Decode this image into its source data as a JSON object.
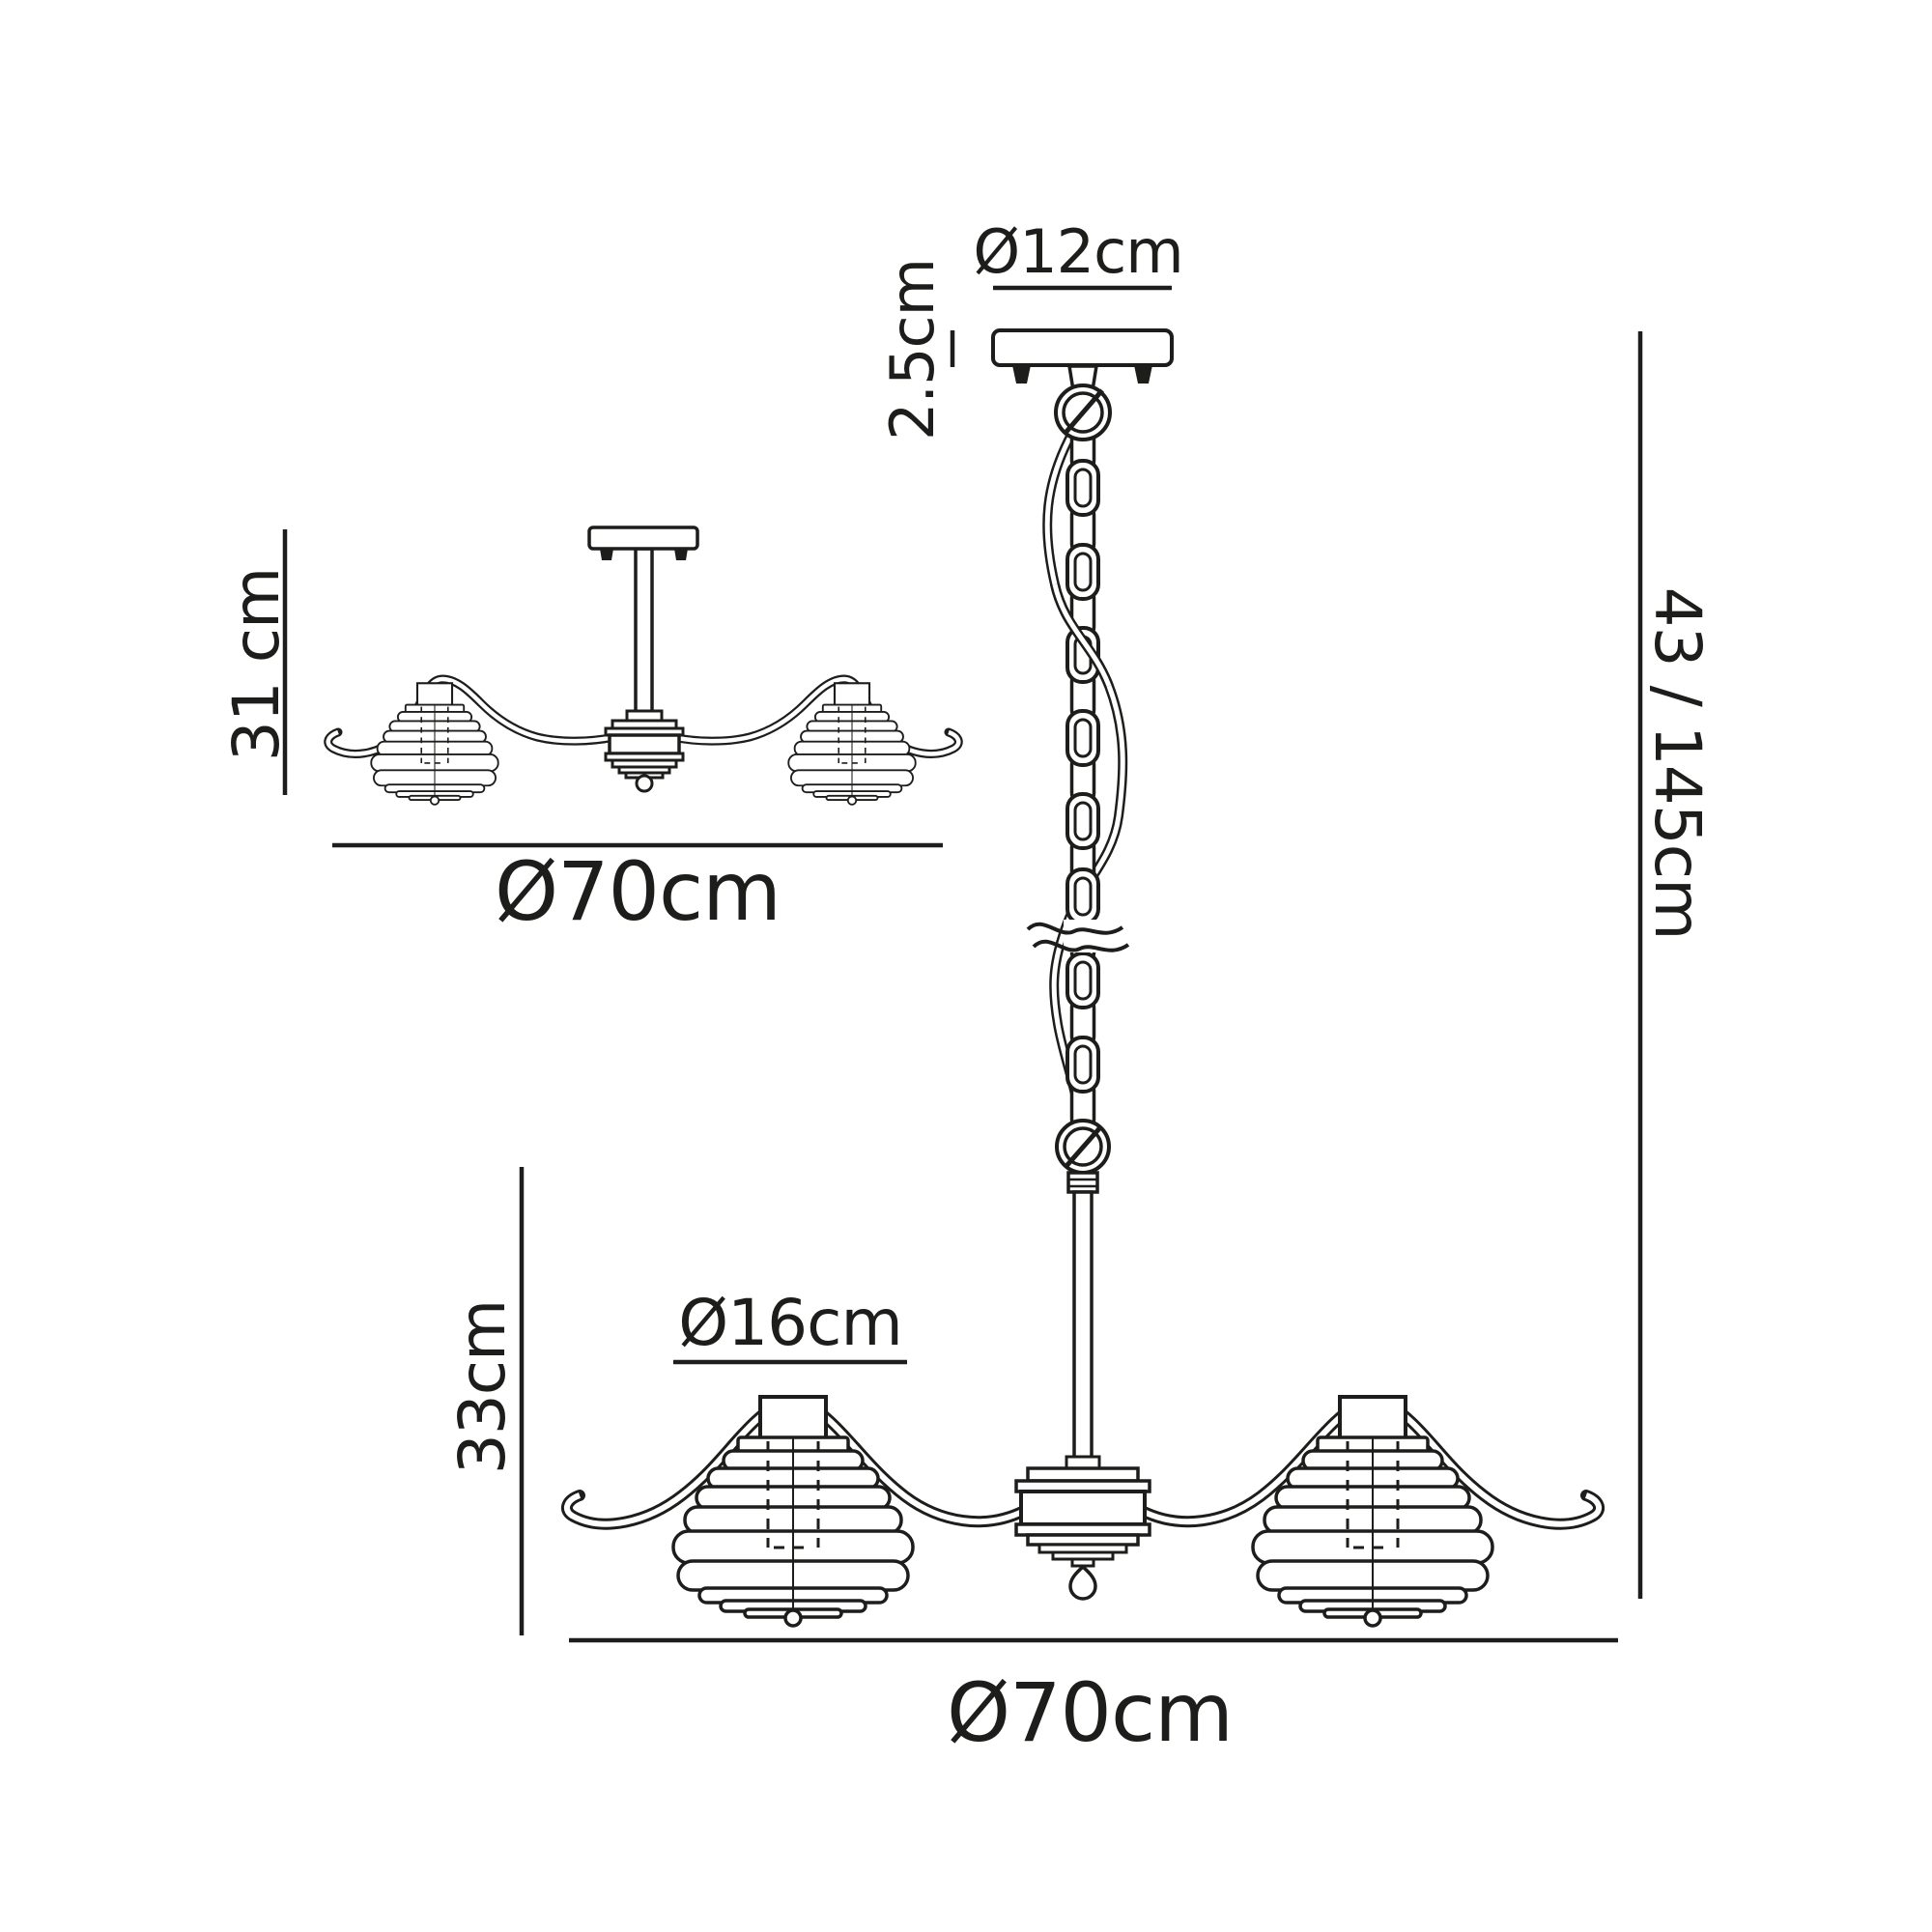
{
  "colors": {
    "line": "#1d1d1b",
    "background": "#ffffff"
  },
  "semi_flush_view": {
    "name": "semi-flush ceiling fitting side view",
    "height_label": "31 cm",
    "width_label": "Ø70cm"
  },
  "pendant_view": {
    "name": "chain pendant side view",
    "canopy_diameter_label": "Ø12cm",
    "canopy_height_label": "2.5cm",
    "overall_height_label": "43 / 145cm",
    "shade_diameter_label": "Ø16cm",
    "fixture_height_label": "33cm",
    "fixture_width_label": "Ø70cm"
  }
}
